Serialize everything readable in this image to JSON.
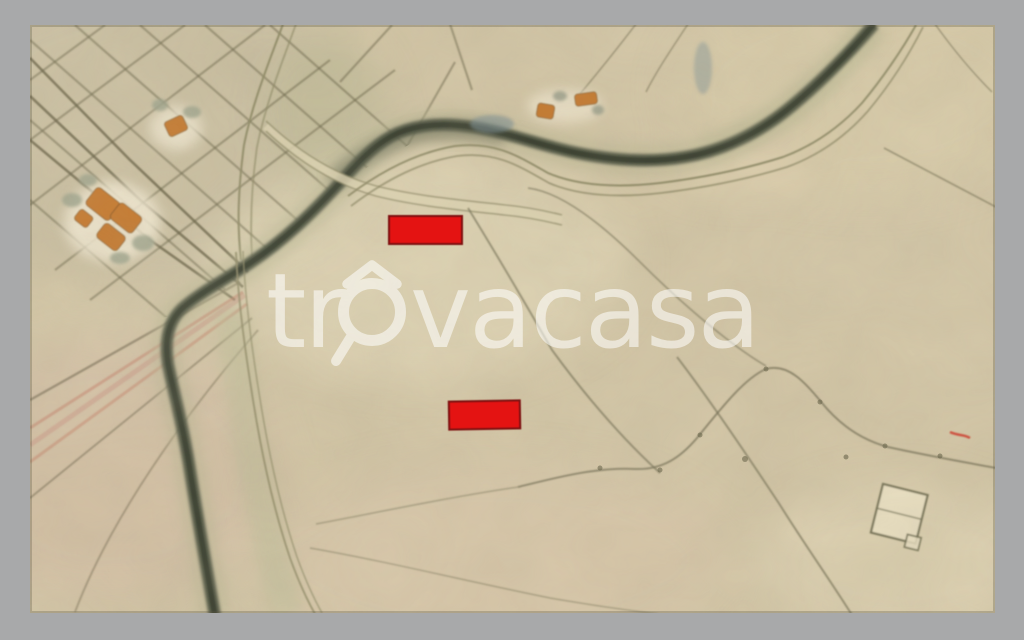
{
  "window": {
    "frame_color": "#a8a9aa"
  },
  "watermark": {
    "full_text": "trovacasa",
    "part1": "tr",
    "part2": "vacasa",
    "color": "#ffffff",
    "opacity": 0.55
  },
  "map": {
    "kind": "historical-cadastral-map",
    "colors": {
      "paper": "#d2c5a5",
      "river": "#49503c",
      "road": "#8f8a66",
      "building": "#c4762c",
      "marker_fill": "#e41312",
      "marker_border": "#7d1010"
    },
    "markers": [
      {
        "id": "marker-1",
        "x": 388,
        "y": 215,
        "w": 75,
        "h": 30,
        "rot": 0
      },
      {
        "id": "marker-2",
        "x": 448,
        "y": 400,
        "w": 73,
        "h": 30,
        "rot": -1
      }
    ]
  }
}
